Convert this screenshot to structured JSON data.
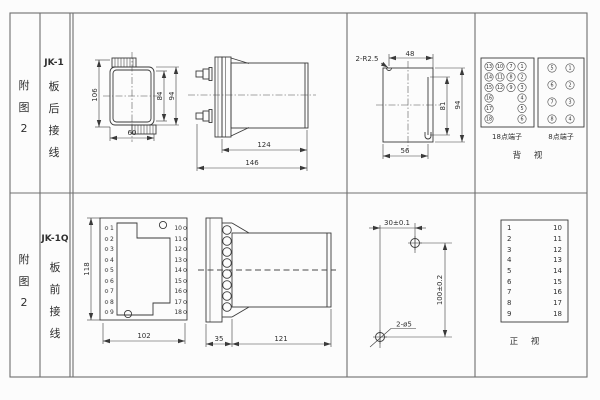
{
  "colors": {
    "background": "#fcfcfc",
    "frame_line": "#6f6f6f",
    "drawing_line": "#3a3a3a",
    "text": "#2f2f2f"
  },
  "row1": {
    "figure_no": {
      "l1": "附",
      "l2": "图",
      "l3": "2"
    },
    "model": "JK-1",
    "wiring": {
      "l1": "板",
      "l2": "后",
      "l3": "接",
      "l4": "线"
    },
    "front_view": {
      "dim_height_total": "106",
      "dim_height_inner": "84",
      "dim_height_outer": "94",
      "dim_width": "60"
    },
    "side_view": {
      "dim_depth_body": "124",
      "dim_depth_total": "146"
    },
    "cutout_view": {
      "radius_note": "2-R2.5",
      "dim_width_top": "48",
      "dim_height_inner": "81",
      "dim_height": "94",
      "dim_width_bottom": "56"
    },
    "terminal18": {
      "caption": "18点端子",
      "cells": [
        "13",
        "10",
        "7",
        "1",
        "14",
        "11",
        "8",
        "2",
        "15",
        "12",
        "9",
        "3",
        "16",
        "4",
        "17",
        "5",
        "18",
        "6"
      ]
    },
    "terminal8": {
      "caption": "8点端子",
      "cells": [
        "5",
        "1",
        "6",
        "2",
        "7",
        "3",
        "8",
        "4"
      ]
    },
    "view_caption": "背 视"
  },
  "row2": {
    "figure_no": {
      "l1": "附",
      "l2": "图",
      "l3": "2"
    },
    "model": "JK-1Q",
    "wiring": {
      "l1": "板",
      "l2": "前",
      "l3": "接",
      "l4": "线"
    },
    "front_view": {
      "dim_height": "118",
      "dim_width": "102",
      "left_terminals": [
        "1",
        "2",
        "3",
        "4",
        "5",
        "6",
        "7",
        "8",
        "9"
      ],
      "right_terminals": [
        "10",
        "11",
        "12",
        "13",
        "14",
        "15",
        "16",
        "17",
        "18"
      ]
    },
    "side_view": {
      "dim_depth_plate": "35",
      "dim_depth_body": "121"
    },
    "drill_view": {
      "dim_horizontal": "30±0.1",
      "dim_vertical": "100±0.2",
      "hole_note": "2-ø5"
    },
    "terminal_table": {
      "left": [
        "1",
        "2",
        "3",
        "4",
        "5",
        "6",
        "7",
        "8",
        "9"
      ],
      "right": [
        "10",
        "11",
        "12",
        "13",
        "14",
        "15",
        "16",
        "17",
        "18"
      ],
      "caption": "正 视"
    }
  }
}
